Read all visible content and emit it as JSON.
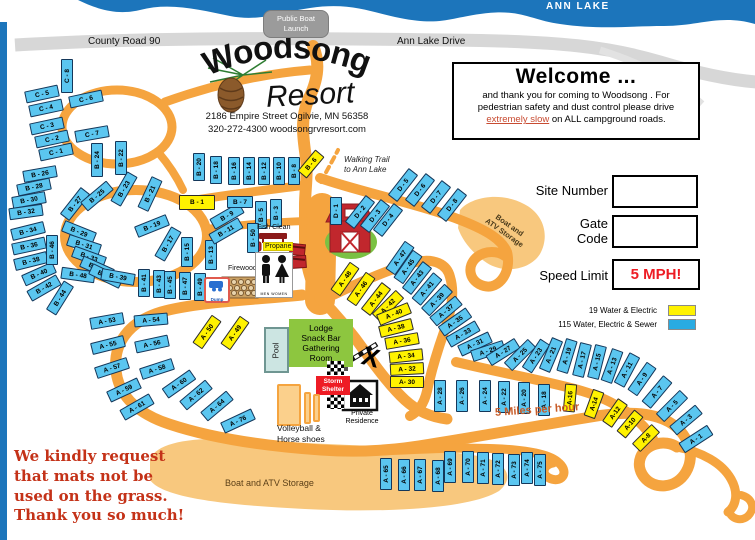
{
  "map": {
    "lake_label": "ANN LAKE",
    "boat_launch": [
      "Public Boat",
      "Launch"
    ],
    "county_road": "County Road 90",
    "ann_lake_drive": "Ann Lake Drive",
    "walking_trail": [
      "Walking Trail",
      "to Ann Lake"
    ],
    "five_mph_road": "5 Miles per hour",
    "x_mark": "X",
    "storage_lower": "Boat and ATV Storage",
    "storage_upper": [
      "Boat and",
      "ATV Storage"
    ]
  },
  "resort": {
    "name": "Woodsong",
    "name2": "Resort",
    "address": "2186  Empire Street Ogilvie,  MN  56358",
    "contact": "320-272-4300   woodsongrvresort.com"
  },
  "welcome": {
    "title": "Welcome ...",
    "line1": "and thank you for coming to Woodsong .  For",
    "line2": "pedestrian safety and dust control please drive",
    "emphasis": "extremely slow",
    "line3_rest": " on ALL campground roads."
  },
  "panel": {
    "site_number": "Site Number",
    "gate": "Gate",
    "code": "Code",
    "speed_limit": "Speed Limit",
    "speed_value": "5 MPH!"
  },
  "legend": {
    "water_electric_label": "19 Water & Electric",
    "water_electric_color": "#FFF200",
    "full_hookup_label": "115 Water, Electric & Sewer",
    "full_hookup_color": "#29ABE2"
  },
  "amenities": {
    "fish_clean": "Fish Clean",
    "propane": "Propane",
    "firewood": "Firewood",
    "dump": "Dump",
    "men": "MEN",
    "women": "WOMEN",
    "pool": "Pool",
    "lodge": [
      "Lodge",
      "Snack Bar",
      "Gathering",
      "Room"
    ],
    "storm_shelter": [
      "Storm",
      "Shelter"
    ],
    "private_residence": [
      "Private",
      "Residence"
    ],
    "recreation": [
      "Volleyball &",
      "Horse shoes"
    ]
  },
  "notice": [
    "We kindly request",
    "that mats not be",
    "used on the grass.",
    "Thank you so much!"
  ],
  "colors": {
    "road_orange": "#F5A43F",
    "road_light": "#F8C87E",
    "lake_blue": "#1C75BB",
    "site_blue": "#5BC6F0",
    "site_yellow": "#FFF200",
    "lodge_green": "#8DC63F",
    "storm_red": "#EE1C25"
  },
  "sites": [
    {
      "l": "C - 8",
      "x": 67,
      "y": 76,
      "r": -90,
      "t": "b"
    },
    {
      "l": "C - 5",
      "x": 42,
      "y": 94,
      "r": -12,
      "t": "b"
    },
    {
      "l": "C - 6",
      "x": 86,
      "y": 99,
      "r": -12,
      "t": "b"
    },
    {
      "l": "C - 4",
      "x": 46,
      "y": 108,
      "r": -12,
      "t": "b"
    },
    {
      "l": "C - 3",
      "x": 47,
      "y": 126,
      "r": -12,
      "t": "b"
    },
    {
      "l": "C - 2",
      "x": 52,
      "y": 139,
      "r": -12,
      "t": "b"
    },
    {
      "l": "C - 1",
      "x": 56,
      "y": 152,
      "r": -12,
      "t": "b"
    },
    {
      "l": "C - 7",
      "x": 92,
      "y": 134,
      "r": -10,
      "t": "b"
    },
    {
      "l": "B - 26",
      "x": 40,
      "y": 174,
      "r": -10,
      "t": "b"
    },
    {
      "l": "B - 28",
      "x": 34,
      "y": 187,
      "r": -12,
      "t": "b"
    },
    {
      "l": "B - 30",
      "x": 29,
      "y": 200,
      "r": -10,
      "t": "b"
    },
    {
      "l": "B - 32",
      "x": 26,
      "y": 212,
      "r": -8,
      "t": "b"
    },
    {
      "l": "B - 34",
      "x": 28,
      "y": 231,
      "r": -14,
      "t": "b"
    },
    {
      "l": "B - 36",
      "x": 29,
      "y": 246,
      "r": -12,
      "t": "b"
    },
    {
      "l": "B - 38",
      "x": 31,
      "y": 261,
      "r": -14,
      "t": "b"
    },
    {
      "l": "B - 40",
      "x": 39,
      "y": 274,
      "r": -24,
      "t": "b"
    },
    {
      "l": "B - 42",
      "x": 44,
      "y": 288,
      "r": -30,
      "t": "b"
    },
    {
      "l": "B - 44",
      "x": 60,
      "y": 298,
      "r": -58,
      "t": "b"
    },
    {
      "l": "B - 46",
      "x": 52,
      "y": 250,
      "r": -90,
      "t": "b",
      "w": 30
    },
    {
      "l": "B - 48",
      "x": 78,
      "y": 275,
      "r": 8,
      "t": "b"
    },
    {
      "l": "B - 24",
      "x": 97,
      "y": 160,
      "r": -90,
      "t": "b"
    },
    {
      "l": "B - 22",
      "x": 121,
      "y": 158,
      "r": -90,
      "t": "b"
    },
    {
      "l": "B - 20",
      "x": 199,
      "y": 167,
      "r": -90,
      "t": "b",
      "w": 28
    },
    {
      "l": "B - 18",
      "x": 216,
      "y": 170,
      "r": -90,
      "t": "b",
      "w": 28
    },
    {
      "l": "B - 16",
      "x": 234,
      "y": 171,
      "r": -90,
      "t": "b",
      "w": 28
    },
    {
      "l": "B - 14",
      "x": 249,
      "y": 171,
      "r": -90,
      "t": "b",
      "w": 28
    },
    {
      "l": "B - 12",
      "x": 264,
      "y": 171,
      "r": -90,
      "t": "b",
      "w": 28
    },
    {
      "l": "B - 10",
      "x": 279,
      "y": 171,
      "r": -90,
      "t": "b",
      "w": 28
    },
    {
      "l": "B - 8",
      "x": 294,
      "y": 171,
      "r": -90,
      "t": "b",
      "w": 28
    },
    {
      "l": "B - 6",
      "x": 311,
      "y": 164,
      "r": -50,
      "t": "y",
      "w": 28
    },
    {
      "l": "B - 27",
      "x": 75,
      "y": 204,
      "r": -52,
      "t": "b"
    },
    {
      "l": "B - 25",
      "x": 97,
      "y": 196,
      "r": -40,
      "t": "b"
    },
    {
      "l": "B - 23",
      "x": 124,
      "y": 189,
      "r": -60,
      "t": "b"
    },
    {
      "l": "B - 21",
      "x": 150,
      "y": 194,
      "r": -65,
      "t": "b"
    },
    {
      "l": "B - 19",
      "x": 152,
      "y": 226,
      "r": -22,
      "t": "b"
    },
    {
      "l": "B - 17",
      "x": 168,
      "y": 244,
      "r": -60,
      "t": "b"
    },
    {
      "l": "B - 15",
      "x": 187,
      "y": 252,
      "r": -90,
      "t": "b",
      "w": 30
    },
    {
      "l": "B - 13",
      "x": 211,
      "y": 255,
      "r": -90,
      "t": "b",
      "w": 30
    },
    {
      "l": "B - 11",
      "x": 226,
      "y": 231,
      "r": -30,
      "t": "b"
    },
    {
      "l": "B - 9",
      "x": 227,
      "y": 216,
      "r": -30,
      "t": "b"
    },
    {
      "l": "B - 1",
      "x": 197,
      "y": 202,
      "r": 0,
      "t": "y",
      "w": 36,
      "h": 15
    },
    {
      "l": "B - 7",
      "x": 240,
      "y": 202,
      "r": 0,
      "t": "b",
      "w": 26
    },
    {
      "l": "B - 5",
      "x": 261,
      "y": 215,
      "r": -90,
      "t": "b",
      "w": 28
    },
    {
      "l": "B - 3",
      "x": 276,
      "y": 213,
      "r": -90,
      "t": "b",
      "w": 28
    },
    {
      "l": "B - 50",
      "x": 253,
      "y": 238,
      "r": -90,
      "t": "b",
      "w": 30
    },
    {
      "l": "B - 29",
      "x": 79,
      "y": 232,
      "r": 22,
      "t": "b"
    },
    {
      "l": "B - 31",
      "x": 84,
      "y": 245,
      "r": 18,
      "t": "b"
    },
    {
      "l": "B - 33",
      "x": 89,
      "y": 257,
      "r": 20,
      "t": "b"
    },
    {
      "l": "B - 35",
      "x": 97,
      "y": 268,
      "r": 24,
      "t": "b"
    },
    {
      "l": "B - 37",
      "x": 106,
      "y": 276,
      "r": 26,
      "t": "b"
    },
    {
      "l": "B - 39",
      "x": 118,
      "y": 277,
      "r": 10,
      "t": "b"
    },
    {
      "l": "B - 41",
      "x": 144,
      "y": 283,
      "r": -90,
      "t": "b",
      "w": 28
    },
    {
      "l": "B - 43",
      "x": 159,
      "y": 284,
      "r": -90,
      "t": "b",
      "w": 28
    },
    {
      "l": "B - 45",
      "x": 170,
      "y": 285,
      "r": -90,
      "t": "b",
      "w": 28
    },
    {
      "l": "B - 47",
      "x": 185,
      "y": 286,
      "r": -90,
      "t": "b",
      "w": 28
    },
    {
      "l": "B - 49",
      "x": 200,
      "y": 287,
      "r": -90,
      "t": "b",
      "w": 28
    },
    {
      "l": "D - 1",
      "x": 336,
      "y": 211,
      "r": -90,
      "t": "b",
      "w": 28
    },
    {
      "l": "D - 2",
      "x": 360,
      "y": 212,
      "r": -52,
      "t": "b"
    },
    {
      "l": "D - 3",
      "x": 375,
      "y": 216,
      "r": -52,
      "t": "b"
    },
    {
      "l": "D - 4",
      "x": 388,
      "y": 220,
      "r": -52,
      "t": "b"
    },
    {
      "l": "D - 5",
      "x": 403,
      "y": 185,
      "r": -52,
      "t": "b"
    },
    {
      "l": "D - 6",
      "x": 420,
      "y": 190,
      "r": -52,
      "t": "b"
    },
    {
      "l": "D - 7",
      "x": 436,
      "y": 197,
      "r": -52,
      "t": "b"
    },
    {
      "l": "D - 8",
      "x": 452,
      "y": 205,
      "r": -52,
      "t": "b"
    },
    {
      "l": "A - 48",
      "x": 345,
      "y": 279,
      "r": -55,
      "t": "y"
    },
    {
      "l": "A - 46",
      "x": 361,
      "y": 289,
      "r": -55,
      "t": "y"
    },
    {
      "l": "A - 44",
      "x": 376,
      "y": 299,
      "r": -52,
      "t": "y"
    },
    {
      "l": "A - 42",
      "x": 388,
      "y": 306,
      "r": -45,
      "t": "y"
    },
    {
      "l": "A - 40",
      "x": 394,
      "y": 314,
      "r": -22,
      "t": "y"
    },
    {
      "l": "A - 38",
      "x": 396,
      "y": 328,
      "r": -14,
      "t": "y"
    },
    {
      "l": "A - 36",
      "x": 402,
      "y": 341,
      "r": -10,
      "t": "y"
    },
    {
      "l": "A - 34",
      "x": 406,
      "y": 356,
      "r": -6,
      "t": "y"
    },
    {
      "l": "A - 32",
      "x": 407,
      "y": 369,
      "r": -3,
      "t": "y"
    },
    {
      "l": "A- 30",
      "x": 407,
      "y": 382,
      "r": 0,
      "t": "y"
    },
    {
      "l": "A - 47",
      "x": 400,
      "y": 258,
      "r": -55,
      "t": "b"
    },
    {
      "l": "A - 45",
      "x": 408,
      "y": 267,
      "r": -55,
      "t": "b"
    },
    {
      "l": "A - 43",
      "x": 417,
      "y": 278,
      "r": -52,
      "t": "b"
    },
    {
      "l": "A - 41",
      "x": 427,
      "y": 289,
      "r": -50,
      "t": "b"
    },
    {
      "l": "A - 39",
      "x": 437,
      "y": 300,
      "r": -46,
      "t": "b"
    },
    {
      "l": "A - 37",
      "x": 446,
      "y": 311,
      "r": -40,
      "t": "b"
    },
    {
      "l": "A - 35",
      "x": 455,
      "y": 322,
      "r": -35,
      "t": "b"
    },
    {
      "l": "A - 33",
      "x": 463,
      "y": 334,
      "r": -30,
      "t": "b"
    },
    {
      "l": "A - 31",
      "x": 475,
      "y": 344,
      "r": -25,
      "t": "b"
    },
    {
      "l": "A - 29",
      "x": 488,
      "y": 351,
      "r": -18,
      "t": "b"
    },
    {
      "l": "A - 27",
      "x": 503,
      "y": 352,
      "r": -32,
      "t": "b"
    },
    {
      "l": "A - 25",
      "x": 520,
      "y": 355,
      "r": -45,
      "t": "b"
    },
    {
      "l": "A - 23",
      "x": 536,
      "y": 356,
      "r": -57,
      "t": "b"
    },
    {
      "l": "A - 21",
      "x": 551,
      "y": 355,
      "r": -67,
      "t": "b"
    },
    {
      "l": "A - 19",
      "x": 567,
      "y": 356,
      "r": -73,
      "t": "b"
    },
    {
      "l": "A - 17",
      "x": 582,
      "y": 360,
      "r": -76,
      "t": "b"
    },
    {
      "l": "A - 15",
      "x": 597,
      "y": 362,
      "r": -76,
      "t": "b"
    },
    {
      "l": "A - 13",
      "x": 612,
      "y": 366,
      "r": -70,
      "t": "b"
    },
    {
      "l": "A - 11",
      "x": 627,
      "y": 370,
      "r": -62,
      "t": "b"
    },
    {
      "l": "A - 9",
      "x": 642,
      "y": 379,
      "r": -55,
      "t": "b"
    },
    {
      "l": "A - 7",
      "x": 657,
      "y": 392,
      "r": -50,
      "t": "b"
    },
    {
      "l": "A - 5",
      "x": 672,
      "y": 406,
      "r": -45,
      "t": "b"
    },
    {
      "l": "A - 3",
      "x": 686,
      "y": 420,
      "r": -40,
      "t": "b"
    },
    {
      "l": "A - 1",
      "x": 696,
      "y": 439,
      "r": -33,
      "t": "b"
    },
    {
      "l": "A - 28",
      "x": 440,
      "y": 396,
      "r": -90,
      "t": "b",
      "w": 32
    },
    {
      "l": "A - 26",
      "x": 462,
      "y": 396,
      "r": -90,
      "t": "b",
      "w": 32
    },
    {
      "l": "A - 24",
      "x": 485,
      "y": 396,
      "r": -90,
      "t": "b",
      "w": 32
    },
    {
      "l": "A - 22",
      "x": 504,
      "y": 397,
      "r": -90,
      "t": "b",
      "w": 32
    },
    {
      "l": "A - 20",
      "x": 524,
      "y": 398,
      "r": -90,
      "t": "b",
      "w": 32
    },
    {
      "l": "A - 18",
      "x": 544,
      "y": 400,
      "r": -90,
      "t": "b",
      "w": 32
    },
    {
      "l": "A-16",
      "x": 570,
      "y": 398,
      "r": -85,
      "t": "y",
      "w": 28
    },
    {
      "l": "A-14",
      "x": 594,
      "y": 404,
      "r": -70,
      "t": "y",
      "w": 28
    },
    {
      "l": "A-12",
      "x": 615,
      "y": 413,
      "r": -55,
      "t": "y",
      "w": 28
    },
    {
      "l": "A-10",
      "x": 630,
      "y": 424,
      "r": -50,
      "t": "y",
      "w": 28
    },
    {
      "l": "A-8",
      "x": 646,
      "y": 438,
      "r": -45,
      "t": "y",
      "w": 28
    },
    {
      "l": "A - 50",
      "x": 207,
      "y": 332,
      "r": -55,
      "t": "y"
    },
    {
      "l": "A - 49",
      "x": 235,
      "y": 333,
      "r": -55,
      "t": "y"
    },
    {
      "l": "A - 53",
      "x": 107,
      "y": 321,
      "r": -10,
      "t": "b"
    },
    {
      "l": "A - 54",
      "x": 151,
      "y": 320,
      "r": -5,
      "t": "b"
    },
    {
      "l": "A - 55",
      "x": 108,
      "y": 345,
      "r": -14,
      "t": "b"
    },
    {
      "l": "A - 56",
      "x": 152,
      "y": 344,
      "r": -12,
      "t": "b"
    },
    {
      "l": "A - 57",
      "x": 112,
      "y": 368,
      "r": -18,
      "t": "b"
    },
    {
      "l": "A - 58",
      "x": 157,
      "y": 369,
      "r": -18,
      "t": "b"
    },
    {
      "l": "A - 59",
      "x": 124,
      "y": 390,
      "r": -25,
      "t": "b"
    },
    {
      "l": "A - 60",
      "x": 179,
      "y": 384,
      "r": -35,
      "t": "b"
    },
    {
      "l": "A - 61",
      "x": 137,
      "y": 407,
      "r": -30,
      "t": "b"
    },
    {
      "l": "A - 62",
      "x": 196,
      "y": 395,
      "r": -40,
      "t": "b"
    },
    {
      "l": "A - 64",
      "x": 217,
      "y": 406,
      "r": -40,
      "t": "b"
    },
    {
      "l": "A - 76",
      "x": 238,
      "y": 421,
      "r": -25,
      "t": "b"
    },
    {
      "l": "A - 65",
      "x": 386,
      "y": 474,
      "r": -90,
      "t": "b",
      "w": 32
    },
    {
      "l": "A - 66",
      "x": 404,
      "y": 475,
      "r": -90,
      "t": "b",
      "w": 32
    },
    {
      "l": "A - 67",
      "x": 420,
      "y": 475,
      "r": -90,
      "t": "b",
      "w": 32
    },
    {
      "l": "A - 68",
      "x": 438,
      "y": 476,
      "r": -90,
      "t": "b",
      "w": 32
    },
    {
      "l": "A - 69",
      "x": 450,
      "y": 467,
      "r": -90,
      "t": "b",
      "w": 32
    },
    {
      "l": "A - 70",
      "x": 468,
      "y": 467,
      "r": -90,
      "t": "b",
      "w": 32
    },
    {
      "l": "A - 71",
      "x": 483,
      "y": 468,
      "r": -90,
      "t": "b",
      "w": 32
    },
    {
      "l": "A - 72",
      "x": 498,
      "y": 469,
      "r": -90,
      "t": "b",
      "w": 32
    },
    {
      "l": "A - 73",
      "x": 514,
      "y": 470,
      "r": -90,
      "t": "b",
      "w": 32
    },
    {
      "l": "A - 74",
      "x": 527,
      "y": 468,
      "r": -90,
      "t": "b",
      "w": 32
    },
    {
      "l": "A - 75",
      "x": 540,
      "y": 470,
      "r": -90,
      "t": "b",
      "w": 32
    }
  ]
}
